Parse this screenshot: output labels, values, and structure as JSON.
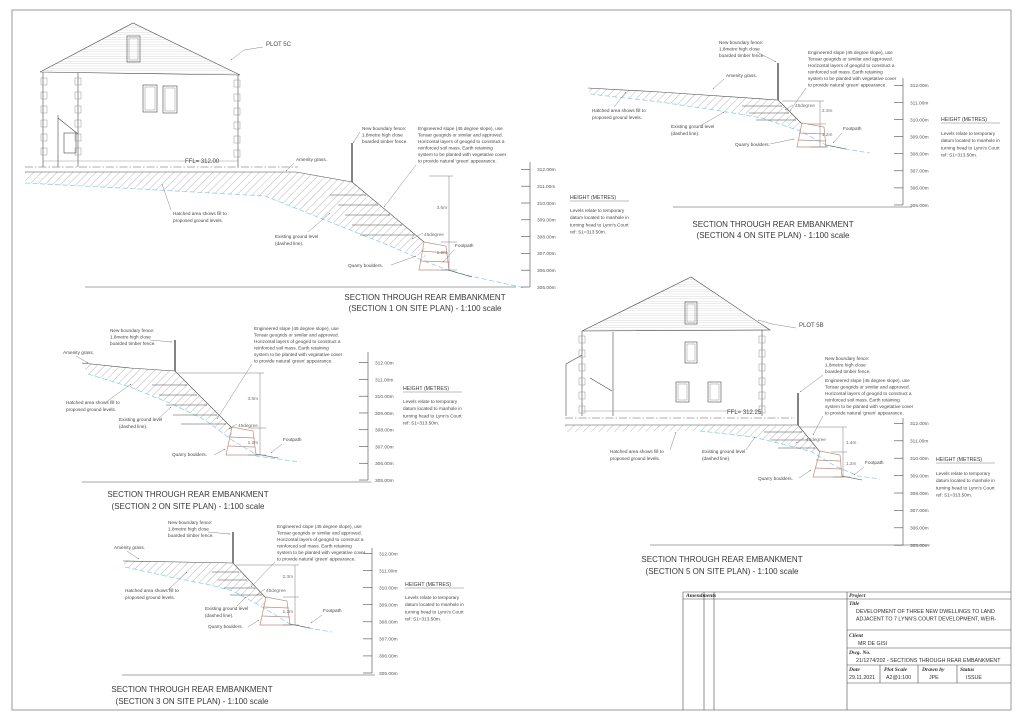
{
  "common": {
    "fence_note": [
      "New boundary fence:",
      "1.8metre high close",
      "boarded timber fence."
    ],
    "engineered_note": [
      "Engineered slope (45 degree slope), use",
      "Tensar geogrids or similar and approved.",
      "Horizontal layers of geogrid to construct a",
      "reinforced soil mass.  Earth retaining",
      "system to be planted with vegetative cover",
      "to provide natural 'green' appearance."
    ],
    "amenity_grass": "Amenity grass.",
    "hatched_note": [
      "Hatched area shows fill to",
      "proposed ground levels."
    ],
    "existing_note": [
      "Existing ground level",
      "(dashed line)."
    ],
    "quarry_boulders": "Quarry boulders.",
    "footpath": "Footpath",
    "slope_angle": "45degree",
    "height_title": "HEIGHT (METRES)",
    "height_note": [
      "Levels relate to temporary",
      "datum located to manhole in",
      "turning head to Lynn's Court",
      "ref: S1=313.50m."
    ],
    "levels": [
      "312.00m",
      "311.00m",
      "310.00m",
      "309.00m",
      "308.00m",
      "307.00m",
      "306.00m",
      "305.00m"
    ]
  },
  "sections": {
    "s1": {
      "title1": "SECTION THROUGH REAR EMBANKMENT",
      "title2": "(SECTION 1 ON SITE PLAN) - 1:100 scale",
      "plot": "PLOT 5C",
      "ffl": "FFL= 312.00",
      "dim_upper": "3.6m",
      "dim_lower": "1.2m"
    },
    "s2": {
      "title1": "SECTION THROUGH REAR EMBANKMENT",
      "title2": "(SECTION 2 ON SITE PLAN) - 1:100 scale",
      "dim_upper": "3.5m",
      "dim_lower": "1.2m"
    },
    "s3": {
      "title1": "SECTION THROUGH REAR EMBANKMENT",
      "title2": "(SECTION 3 ON SITE PLAN) - 1:100 scale",
      "dim_upper": "2.3m",
      "dim_lower": "1.2m"
    },
    "s4": {
      "title1": "SECTION THROUGH REAR EMBANKMENT",
      "title2": "(SECTION 4 ON SITE PLAN) - 1:100 scale",
      "dim_upper": "2.3m",
      "dim_lower": "1.2m"
    },
    "s5": {
      "title1": "SECTION THROUGH REAR EMBANKMENT",
      "title2": "(SECTION 5 ON SITE PLAN) - 1:100 scale",
      "plot": "PLOT 5B",
      "ffl": "FFL= 312.25",
      "dim_upper": "1.4m",
      "dim_lower": "1.2m"
    }
  },
  "title_block": {
    "amendments_label": "Amendments",
    "project_label": "Project",
    "title_label": "Title",
    "title_lines": [
      "DEVELOPMENT OF THREE NEW DWELLINGS TO LAND",
      "ADJACENT TO 7 LYNN'S COURT DEVELOPMENT, WEIR-"
    ],
    "client_label": "Client",
    "client_value": "MR DE GISI",
    "dwg_label": "Dwg. No.",
    "dwg_value": "21/1274/202 - SECTIONS THROUGH REAR EMBANKMENT",
    "date_label": "Date",
    "date_value": "29.11.2021",
    "plot_scale_label": "Plot Scale",
    "plot_scale_value": "A2@1:100",
    "drawn_by_label": "Drawn by",
    "drawn_by_value": "JPE",
    "status_label": "Status",
    "status_value": "ISSUE"
  }
}
